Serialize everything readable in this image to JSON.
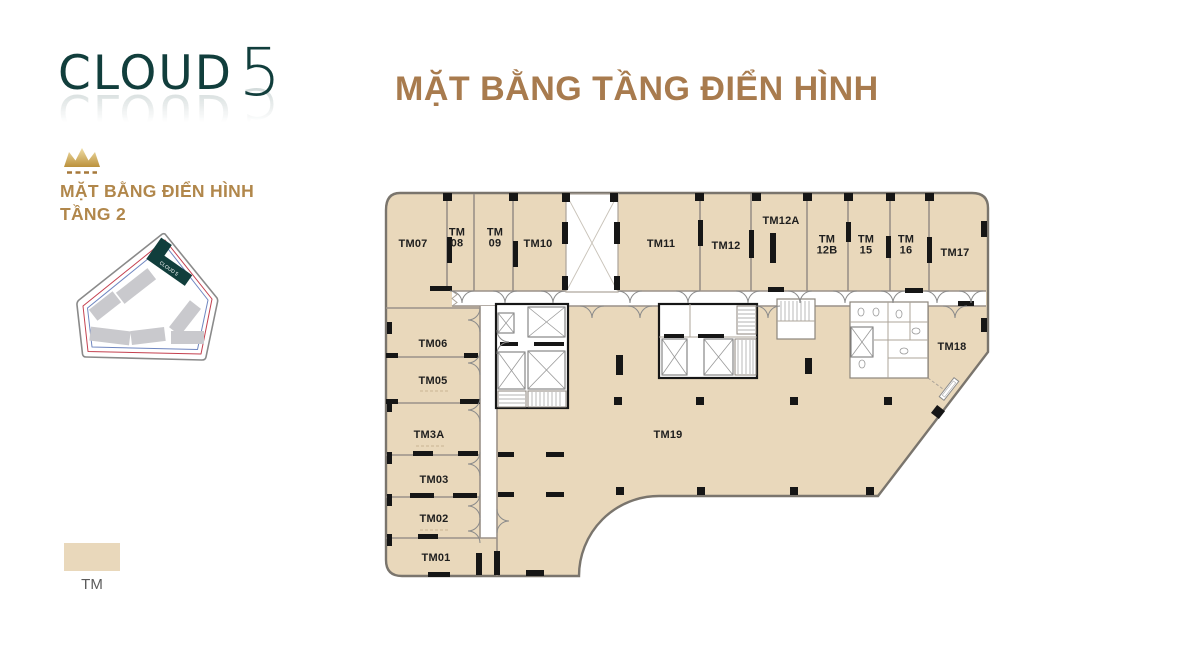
{
  "branding": {
    "logo_word": "CLOUD",
    "logo_digit": "5",
    "logo_color": "#113e3c"
  },
  "header": {
    "title": "MẶT BẰNG TẦNG ĐIỂN HÌNH",
    "title_color": "#a87b4e"
  },
  "sidebar": {
    "plan_label_line1": "MẶT BẰNG ĐIỂN HÌNH",
    "plan_label_line2": "TẦNG 2",
    "label_color": "#b1874b",
    "sitemap_building_label": "CLOUD 5"
  },
  "legend": {
    "label": "TM",
    "swatch_color": "#e9d8bb"
  },
  "colors": {
    "unit_fill": "#e9d8bb",
    "wall_gray": "#9a9189",
    "wall_black": "#161616",
    "gold_accent": "#c9a44c",
    "site_outline_red": "#c4404f",
    "site_outline_blue": "#6f86c0",
    "site_building_gray": "#c9c9cd",
    "site_building_dark": "#113e3c"
  },
  "floorplan": {
    "units": [
      {
        "id": "TM07",
        "lines": [
          "TM07"
        ],
        "x": 413,
        "y": 247
      },
      {
        "id": "TM08",
        "lines": [
          "TM",
          "08"
        ],
        "x": 457,
        "y": 241
      },
      {
        "id": "TM09",
        "lines": [
          "TM",
          "09"
        ],
        "x": 495,
        "y": 241
      },
      {
        "id": "TM10",
        "lines": [
          "TM10"
        ],
        "x": 538,
        "y": 247
      },
      {
        "id": "TM11",
        "lines": [
          "TM11"
        ],
        "x": 661,
        "y": 247
      },
      {
        "id": "TM12",
        "lines": [
          "TM12"
        ],
        "x": 726,
        "y": 249
      },
      {
        "id": "TM12A",
        "lines": [
          "TM12A"
        ],
        "x": 781,
        "y": 224
      },
      {
        "id": "TM12B",
        "lines": [
          "TM",
          "12B"
        ],
        "x": 827,
        "y": 248
      },
      {
        "id": "TM15",
        "lines": [
          "TM",
          "15"
        ],
        "x": 866,
        "y": 248
      },
      {
        "id": "TM16",
        "lines": [
          "TM",
          "16"
        ],
        "x": 906,
        "y": 248
      },
      {
        "id": "TM17",
        "lines": [
          "TM17"
        ],
        "x": 955,
        "y": 256
      },
      {
        "id": "TM18",
        "lines": [
          "TM18"
        ],
        "x": 952,
        "y": 350
      },
      {
        "id": "TM06",
        "lines": [
          "TM06"
        ],
        "x": 433,
        "y": 347
      },
      {
        "id": "TM05",
        "lines": [
          "TM05"
        ],
        "x": 433,
        "y": 384
      },
      {
        "id": "TM3A",
        "lines": [
          "TM3A"
        ],
        "x": 429,
        "y": 438
      },
      {
        "id": "TM03",
        "lines": [
          "TM03"
        ],
        "x": 434,
        "y": 483
      },
      {
        "id": "TM02",
        "lines": [
          "TM02"
        ],
        "x": 434,
        "y": 522
      },
      {
        "id": "TM01",
        "lines": [
          "TM01"
        ],
        "x": 436,
        "y": 561
      },
      {
        "id": "TM19",
        "lines": [
          "TM19"
        ],
        "x": 668,
        "y": 438
      }
    ]
  }
}
